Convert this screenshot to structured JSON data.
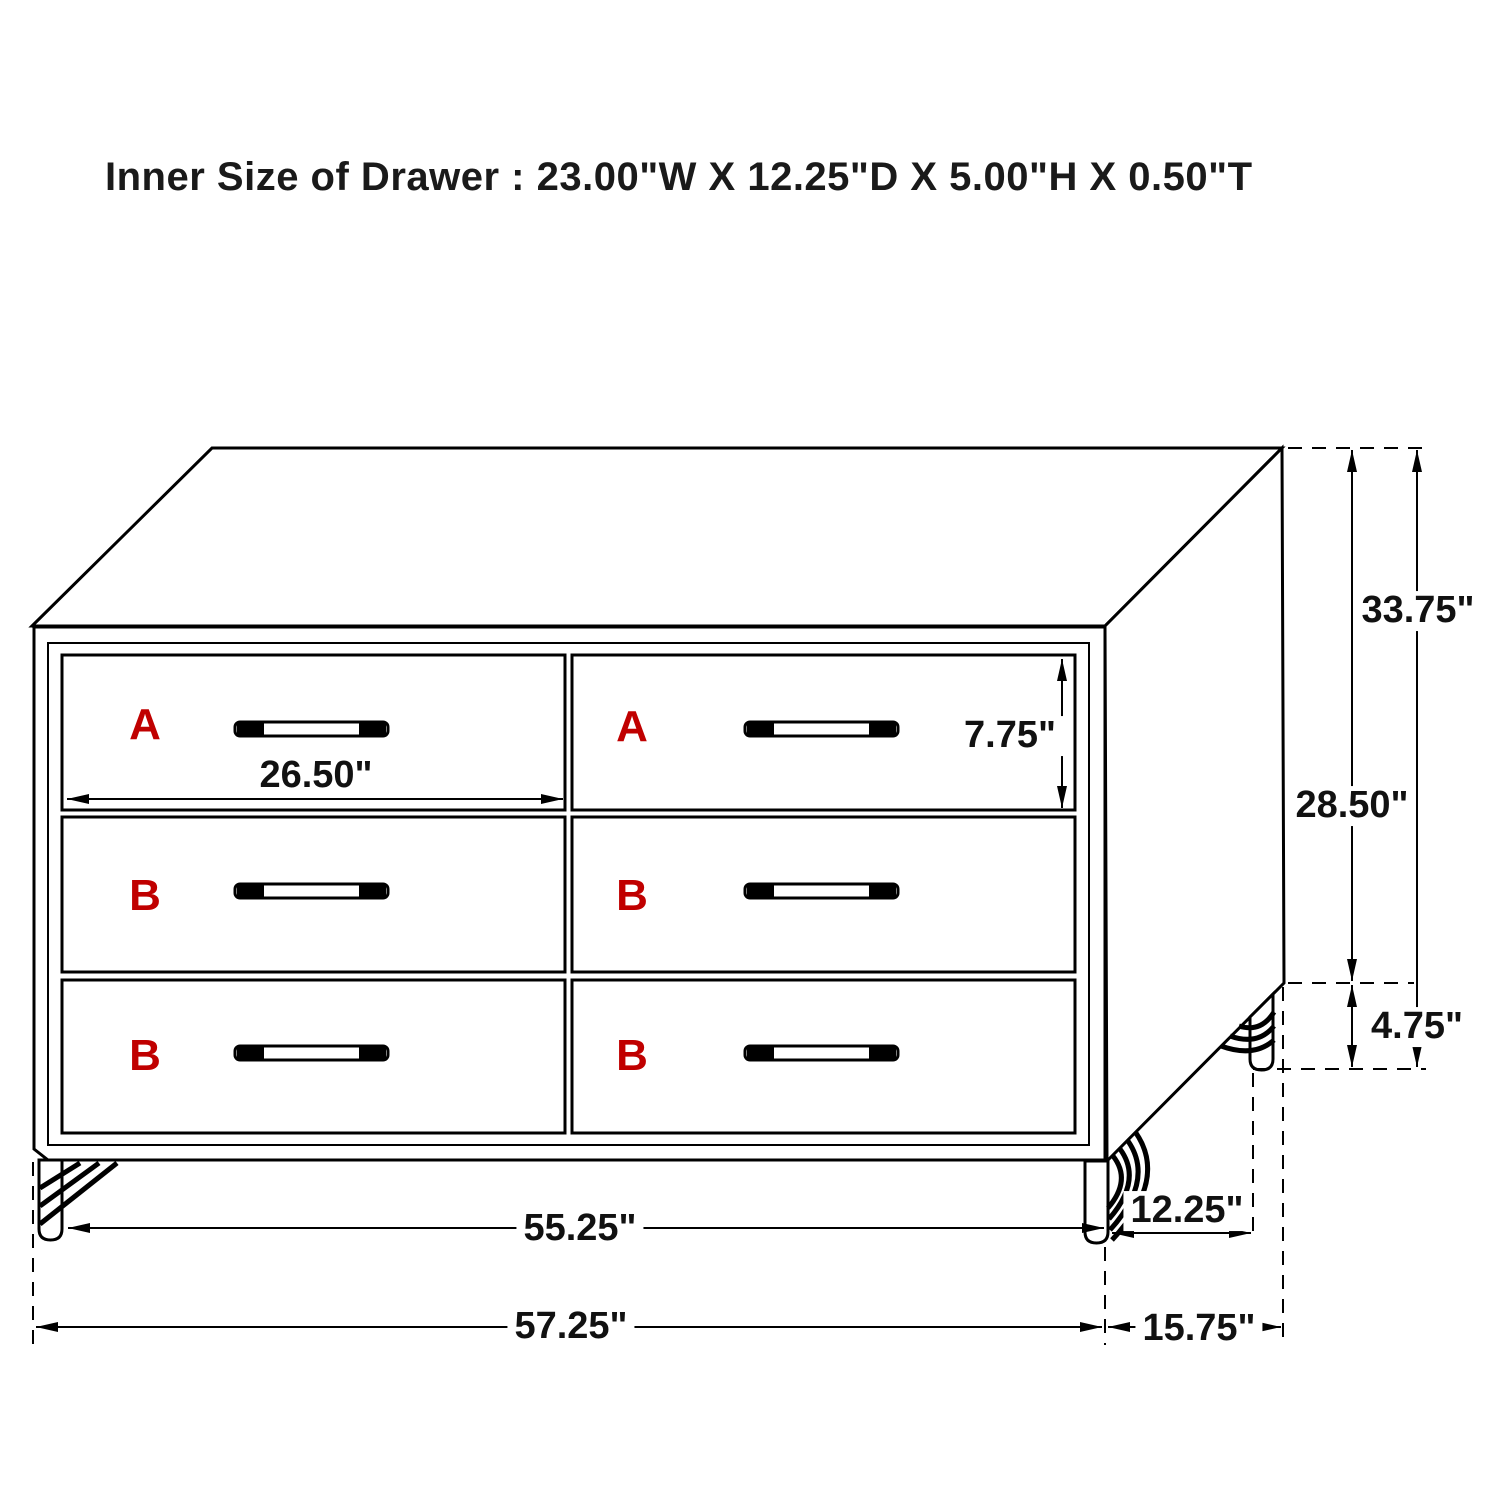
{
  "title": "Inner Size of Drawer : 23.00\"W X 12.25\"D X 5.00\"H X 0.50\"T",
  "colors": {
    "line": "#000000",
    "label_red": "#c00000",
    "text": "#1a1a1a",
    "background": "#ffffff"
  },
  "drawer_labels": {
    "top_left": "A",
    "top_right": "A",
    "middle_left": "B",
    "middle_right": "B",
    "bottom_left": "B",
    "bottom_right": "B"
  },
  "dimensions": {
    "drawer_width": "26.50\"",
    "drawer_front_height": "7.75\"",
    "overall_height": "33.75\"",
    "case_height": "28.50\"",
    "leg_height": "4.75\"",
    "front_leg_span": "55.25\"",
    "drawer_inner_depth": "12.25\"",
    "overall_width": "57.25\"",
    "overall_depth": "15.75\""
  }
}
